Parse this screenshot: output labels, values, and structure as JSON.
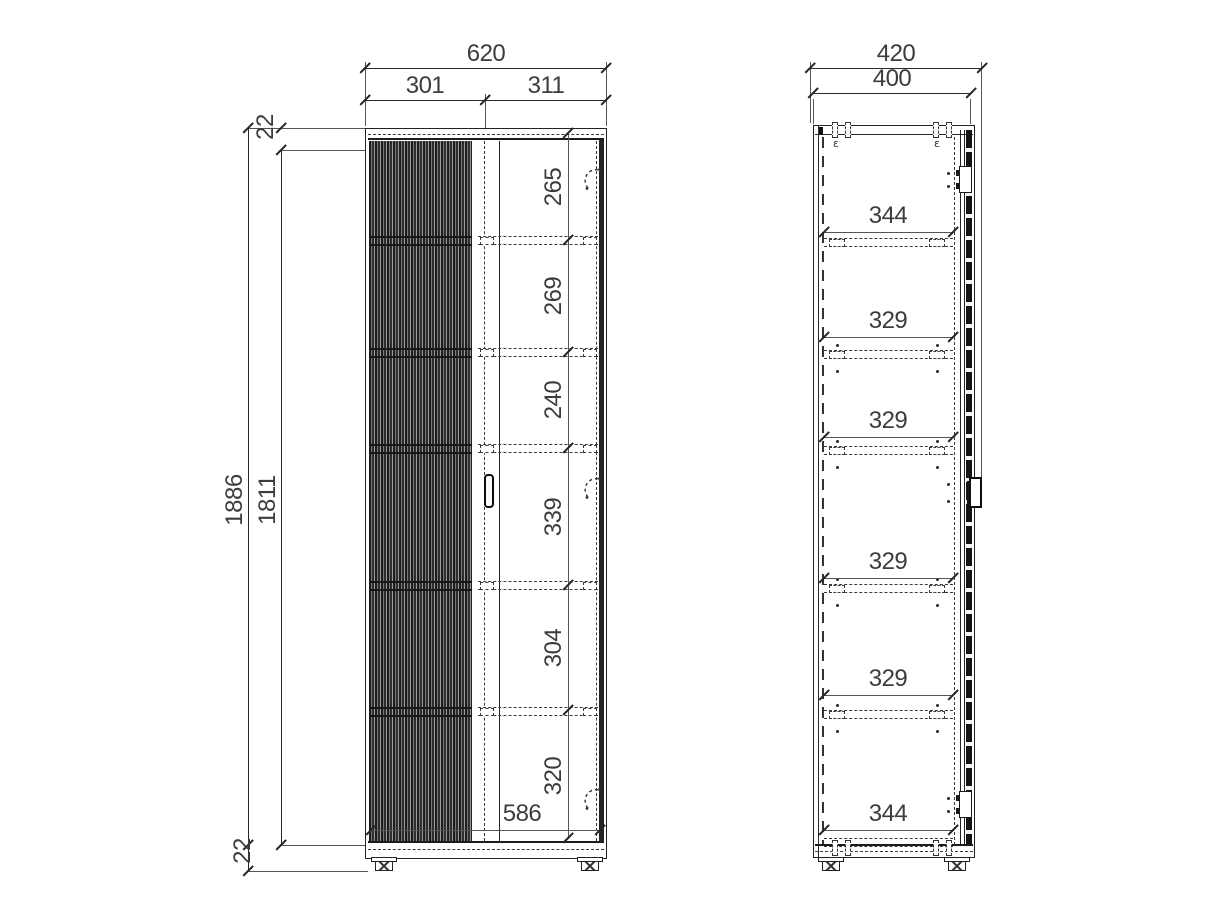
{
  "drawing_type": "furniture technical drawing - two-door fluted wardrobe, front and side elevations",
  "front_view": {
    "dims": {
      "total_width": "620",
      "left_door_width": "301",
      "right_door_width": "311",
      "total_height": "1886",
      "interior_height": "1811",
      "top_panel_thickness": "22",
      "bottom_panel_thickness": "22",
      "interior_width": "586",
      "compartment_heights": [
        "265",
        "269",
        "240",
        "339",
        "304",
        "320"
      ]
    }
  },
  "side_view": {
    "dims": {
      "total_depth": "420",
      "body_depth": "400",
      "shelf_depths": [
        "344",
        "329",
        "329",
        "329",
        "329",
        "344"
      ]
    }
  },
  "marks": {
    "hardware": "ɛ"
  },
  "icons": {
    "hinge": "dashed-arc-with-dots",
    "hanger_bracket": "dashed-clip-pair",
    "foot": "adjustable-foot-with-cross-brace"
  },
  "colors": {
    "background": "#ffffff",
    "line": "#2a2a2a",
    "text": "#3c3c3c",
    "flute_dark": "#1d1d1d",
    "flute_light": "#9b9b9b"
  }
}
